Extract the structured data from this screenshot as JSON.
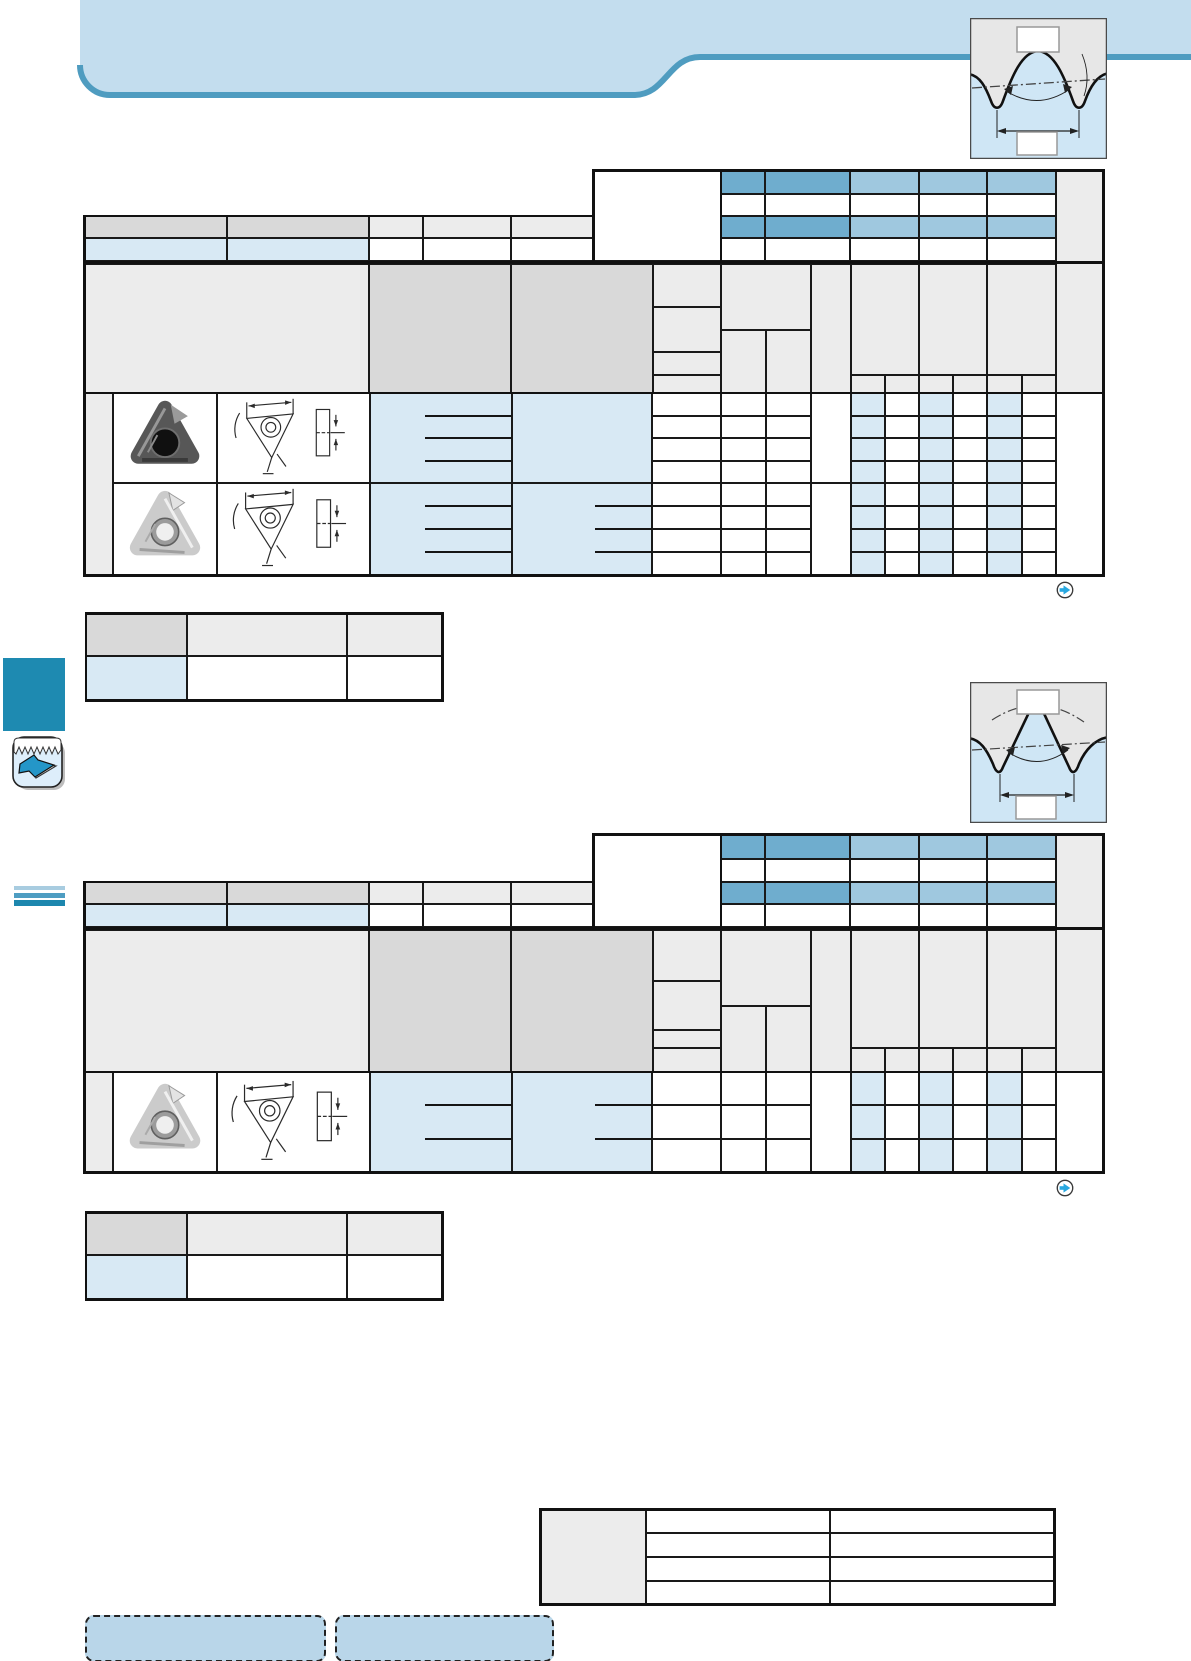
{
  "page": {
    "width": 1191,
    "height": 1661,
    "background": "#ffffff"
  },
  "header_band": {
    "fill": "#c3ddee",
    "accent_line": "#4f9cc0"
  },
  "palette": {
    "head_blue_dark": "#6fadce",
    "head_blue_light": "#9fc8df",
    "cell_blue": "#d8e9f4",
    "gray_dark": "#d9d9d9",
    "gray_light": "#ececec",
    "grid_line": "#191919",
    "diagram_gray": "#e7e7e7",
    "diagram_blue": "#cfe6f5",
    "nav_square_blue": "#1e8ab1",
    "arrow_blue": "#29a8e0",
    "dashed_box_fill": "#b9d6e9",
    "stripe_colors": [
      "#a8cce0",
      "#4e9dc2",
      "#1d87ae"
    ]
  },
  "diagrams": [
    {
      "name": "thread-profile-full",
      "top_label": "",
      "bottom_label": ""
    },
    {
      "name": "thread-profile-partial",
      "top_label": "",
      "bottom_label": ""
    }
  ],
  "tables": {
    "table1": {
      "insert_groups": 2,
      "rows_per_group": 4,
      "grade_columns": 6
    },
    "table2": {
      "insert_groups": 1,
      "rows_per_group": 3,
      "grade_columns": 6
    },
    "small_table1": {
      "rows": 2,
      "columns": 3
    },
    "small_table2": {
      "rows": 2,
      "columns": 3
    },
    "bottom_table": {
      "rows": 4,
      "columns": 3
    }
  },
  "icons": {
    "nav_arrow": "circle-right-arrow",
    "category_tab": "threading-insert"
  }
}
